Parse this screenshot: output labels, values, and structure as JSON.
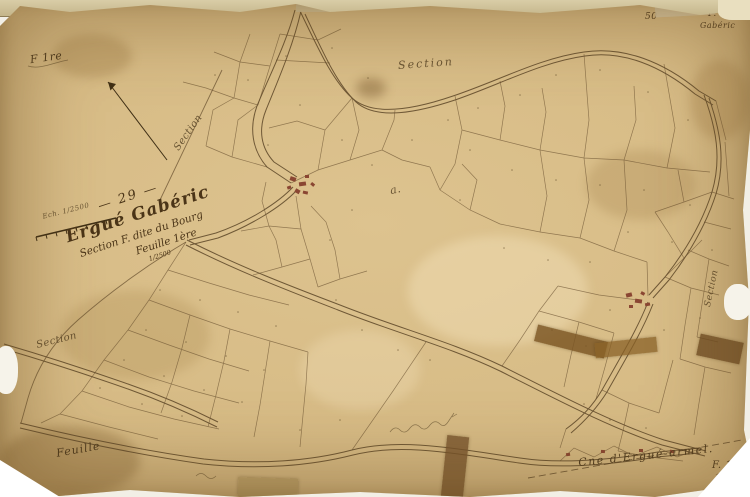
{
  "corner_annotations": {
    "top_left": "F 1re",
    "top_right_number": "50",
    "top_right_sheet": "F. 1",
    "top_right_name": "Gabéric",
    "bottom_right_sheet": "F. 1",
    "bottom_left_sheet": "Feuille"
  },
  "title_block": {
    "plan_number": "— 29 —",
    "commune": "Ergué Gabéric",
    "section_line": "Section F. dite du Bourg",
    "sheet_line": "Feuille 1ère",
    "scale_fraction": "1/2500"
  },
  "scale_bar": {
    "label": "Ech. 1/2500"
  },
  "section_labels": {
    "top": "Section",
    "west": "Section",
    "southwest": "Section",
    "east": "Section"
  },
  "neighbor_labels": {
    "bottom_right_commune": "Cne d'Ergué-armel.",
    "letter_a": "a."
  },
  "colors": {
    "paper": "#d6ba84",
    "ink": "#5d4728",
    "buildings": "#8a4632",
    "tape": "#7a5422",
    "tear": "#f6f3ea"
  }
}
